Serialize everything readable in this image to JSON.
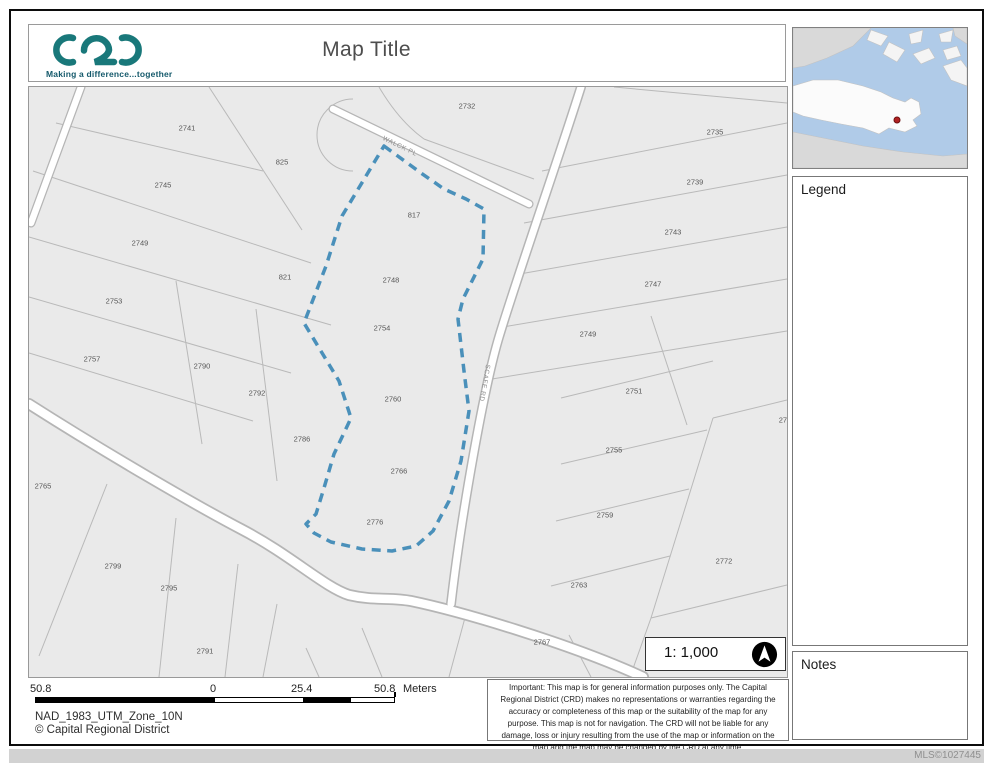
{
  "header": {
    "logo_text": "CRD",
    "tagline": "Making a difference...together",
    "title": "Map Title"
  },
  "sidebar": {
    "legend_title": "Legend",
    "notes_title": "Notes",
    "inset_marker_color": "#b22222"
  },
  "map": {
    "scale_text": "1: 1,000",
    "highlight_color": "#4a90ba",
    "streets": [
      {
        "name": "WALCK PL"
      },
      {
        "name": "SCAFE RD"
      }
    ],
    "parcel_labels": [
      {
        "text": "2741",
        "x": 158,
        "y": 41
      },
      {
        "text": "825",
        "x": 253,
        "y": 75
      },
      {
        "text": "2732",
        "x": 438,
        "y": 19
      },
      {
        "text": "2745",
        "x": 134,
        "y": 98
      },
      {
        "text": "817",
        "x": 385,
        "y": 128
      },
      {
        "text": "2735",
        "x": 686,
        "y": 45
      },
      {
        "text": "2739",
        "x": 666,
        "y": 95
      },
      {
        "text": "2749",
        "x": 111,
        "y": 156
      },
      {
        "text": "2743",
        "x": 644,
        "y": 145
      },
      {
        "text": "821",
        "x": 256,
        "y": 190
      },
      {
        "text": "2748",
        "x": 362,
        "y": 193
      },
      {
        "text": "2747",
        "x": 624,
        "y": 197
      },
      {
        "text": "2753",
        "x": 85,
        "y": 214
      },
      {
        "text": "2754",
        "x": 353,
        "y": 241
      },
      {
        "text": "2749",
        "x": 559,
        "y": 247
      },
      {
        "text": "2757",
        "x": 63,
        "y": 272
      },
      {
        "text": "2790",
        "x": 173,
        "y": 279
      },
      {
        "text": "2751",
        "x": 605,
        "y": 304
      },
      {
        "text": "2792",
        "x": 228,
        "y": 306
      },
      {
        "text": "2760",
        "x": 364,
        "y": 312
      },
      {
        "text": "277",
        "x": 756,
        "y": 333
      },
      {
        "text": "2786",
        "x": 273,
        "y": 352
      },
      {
        "text": "2755",
        "x": 585,
        "y": 363
      },
      {
        "text": "2766",
        "x": 370,
        "y": 384
      },
      {
        "text": "2765",
        "x": 14,
        "y": 399
      },
      {
        "text": "2759",
        "x": 576,
        "y": 428
      },
      {
        "text": "2776",
        "x": 346,
        "y": 435
      },
      {
        "text": "2772",
        "x": 695,
        "y": 474
      },
      {
        "text": "2799",
        "x": 84,
        "y": 479
      },
      {
        "text": "2763",
        "x": 550,
        "y": 498
      },
      {
        "text": "2795",
        "x": 140,
        "y": 501
      },
      {
        "text": "2767",
        "x": 513,
        "y": 555
      },
      {
        "text": "2791",
        "x": 176,
        "y": 564
      }
    ]
  },
  "footer": {
    "scalebar_labels": [
      "50.8",
      "0",
      "25.4",
      "50.8"
    ],
    "scalebar_units": "Meters",
    "projection": "NAD_1983_UTM_Zone_10N",
    "copyright": "© Capital Regional District",
    "disclaimer": "Important: This map is for general information purposes only. The Capital Regional District (CRD) makes no representations or warranties regarding the accuracy or completeness of this map or the suitability of the map for any purpose. This map is not for navigation. The CRD will not be liable for any damage, loss or injury resulting from the use of the map or information on the map and the map may be changed by the CRD at any time.",
    "mls": "MLS©1027445"
  }
}
